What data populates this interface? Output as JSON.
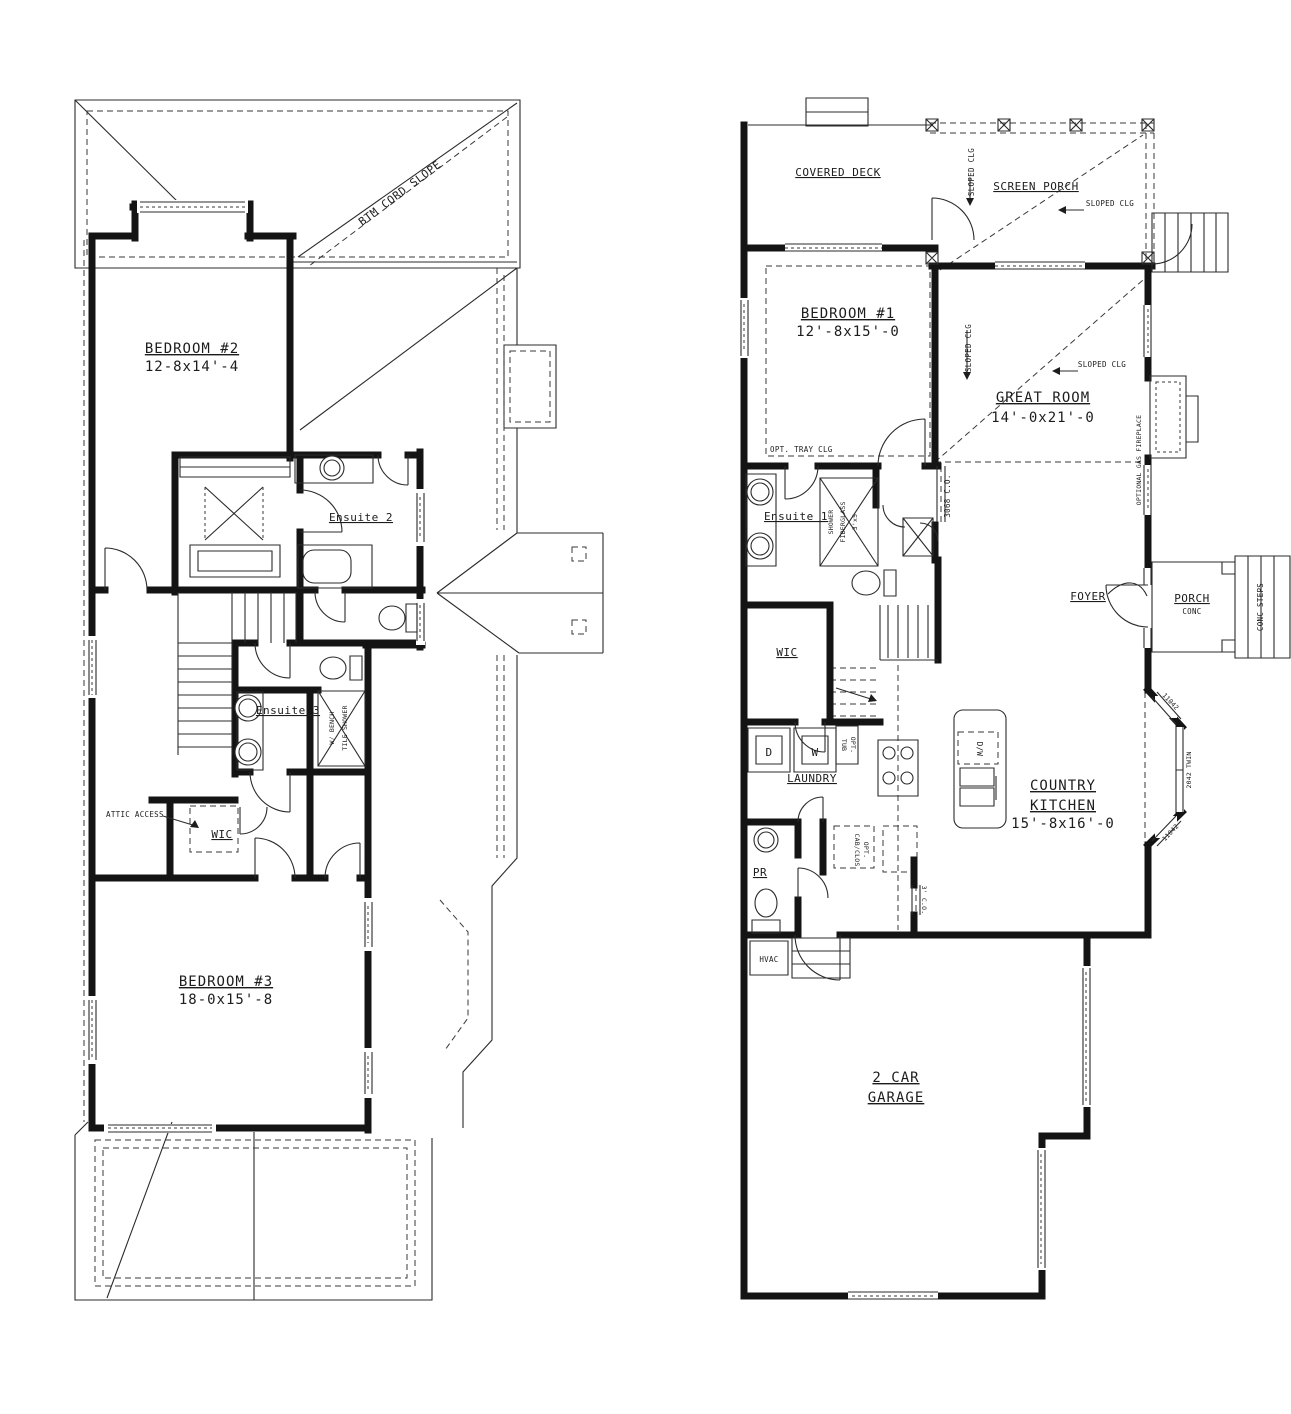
{
  "sheet": {
    "background": "#ffffff",
    "ink": "#1c1c1c"
  },
  "upper_floor": {
    "roof_note": "BTM CORD SLOPE",
    "rooms": {
      "bedroom2": {
        "name": "BEDROOM #2",
        "dims": "12-8x14'-4"
      },
      "ensuite2": {
        "name": "Ensuite 2"
      },
      "ensuite3": {
        "name": "Ensuite 3"
      },
      "wic": {
        "name": "WIC"
      },
      "bedroom3": {
        "name": "BEDROOM #3",
        "dims": "18-0x15'-8"
      }
    },
    "notes": {
      "attic_access": "ATTIC ACCESS",
      "tile_shower_l1": "TILE SHOWER",
      "tile_shower_l2": "W/ BENCH"
    }
  },
  "main_floor": {
    "rooms": {
      "covered_deck": {
        "name": "COVERED DECK"
      },
      "screen_porch": {
        "name": "SCREEN PORCH"
      },
      "bedroom1": {
        "name": "BEDROOM #1",
        "dims": "12'-8x15'-0"
      },
      "great_room": {
        "name": "GREAT ROOM",
        "dims": "14'-0x21'-0"
      },
      "ensuite1": {
        "name": "Ensuite 1"
      },
      "foyer": {
        "name": "FOYER"
      },
      "porch": {
        "name": "PORCH",
        "sub": "CONC"
      },
      "wic": {
        "name": "WIC"
      },
      "laundry": {
        "name": "LAUNDRY"
      },
      "country_kitchen": {
        "l1": "COUNTRY",
        "l2": "KITCHEN",
        "dims": "15'-8x16'-0"
      },
      "pr": {
        "name": "PR"
      },
      "garage": {
        "l1": "2 CAR",
        "l2": "GARAGE"
      }
    },
    "notes": {
      "sloped_clg": "SLOPED CLG",
      "opt_tray_clg": "OPT. TRAY CLG",
      "optional_gas_fireplace": "OPTIONAL GAS FIREPLACE",
      "shower_l1": "SHOWER",
      "shower_l2": "FIBERGLASS",
      "shower_l3": "3'x5",
      "co_3068": "3068 C.O.",
      "co_3ft": "3' C.O.",
      "conc_steps": "CONC STEPS",
      "dryer": "D",
      "washer": "W",
      "tub_l1": "TUB",
      "tub_l2": "OPT.",
      "cab_l1": "CAB/CLOS",
      "cab_l2": "OPT.",
      "dw": "D/W",
      "hvac": "HVAC",
      "win_11042": "11042",
      "win_2042_twin": "2042 TWIN"
    }
  }
}
